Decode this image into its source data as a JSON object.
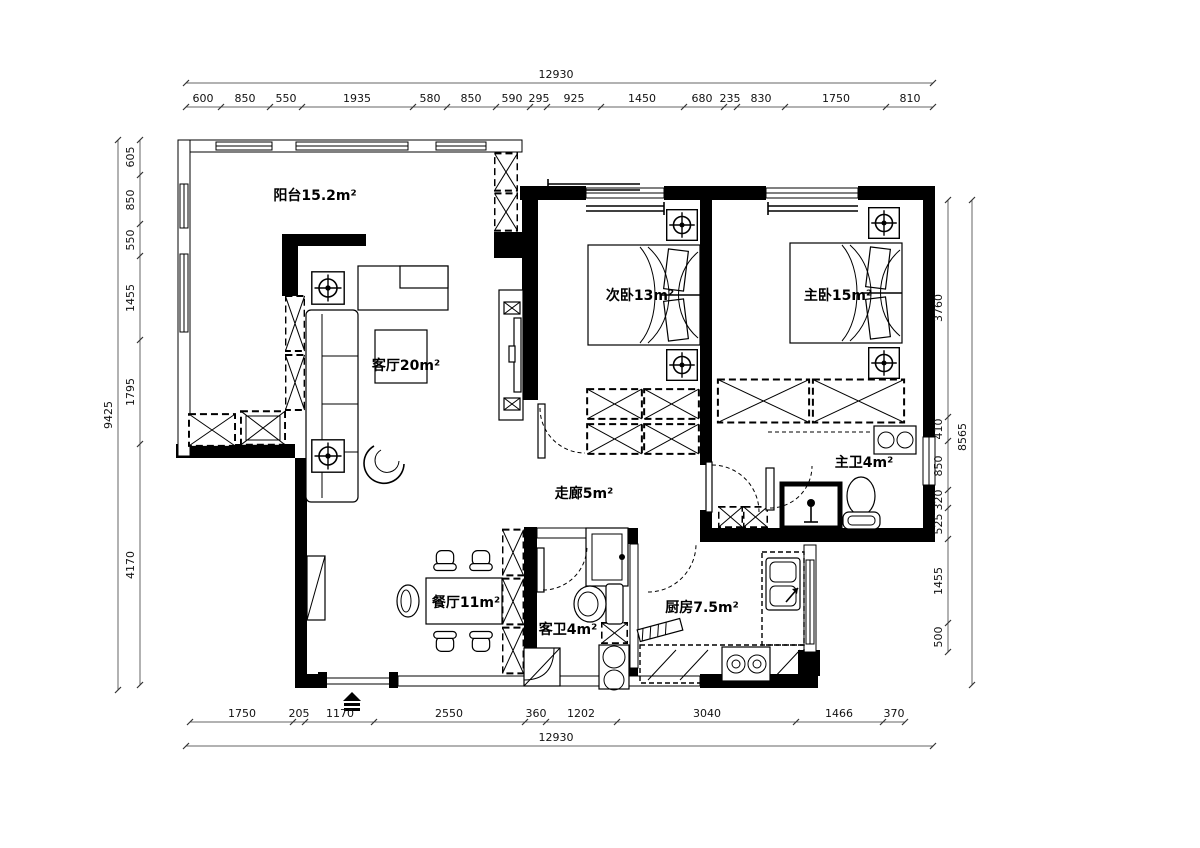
{
  "rooms": {
    "balcony": "阳台15.2m²",
    "living": "客厅20m²",
    "bedroom2": "次卧13m²",
    "master": "主卧15m²",
    "master_bath": "主卫4m²",
    "corridor": "走廊5m²",
    "dining": "餐厅11m²",
    "guest_bath": "客卫4m²",
    "kitchen": "厨房7.5m²"
  },
  "dimensions": {
    "top": {
      "total": "12930",
      "segments": [
        "600",
        "850",
        "550",
        "1935",
        "580",
        "850",
        "590",
        "295",
        "925",
        "1450",
        "680",
        "235",
        "830",
        "1750",
        "810"
      ]
    },
    "bottom": {
      "total": "12930",
      "segments": [
        "1750",
        "205",
        "1170",
        "2550",
        "360",
        "1202",
        "3040",
        "1466",
        "370"
      ]
    },
    "left": {
      "total": "9425",
      "segments": [
        "605",
        "850",
        "550",
        "1455",
        "1795",
        "4170"
      ]
    },
    "right": {
      "total": "8565",
      "segments": [
        "3760",
        "410",
        "850",
        "320",
        "525",
        "1455",
        "500"
      ]
    }
  }
}
